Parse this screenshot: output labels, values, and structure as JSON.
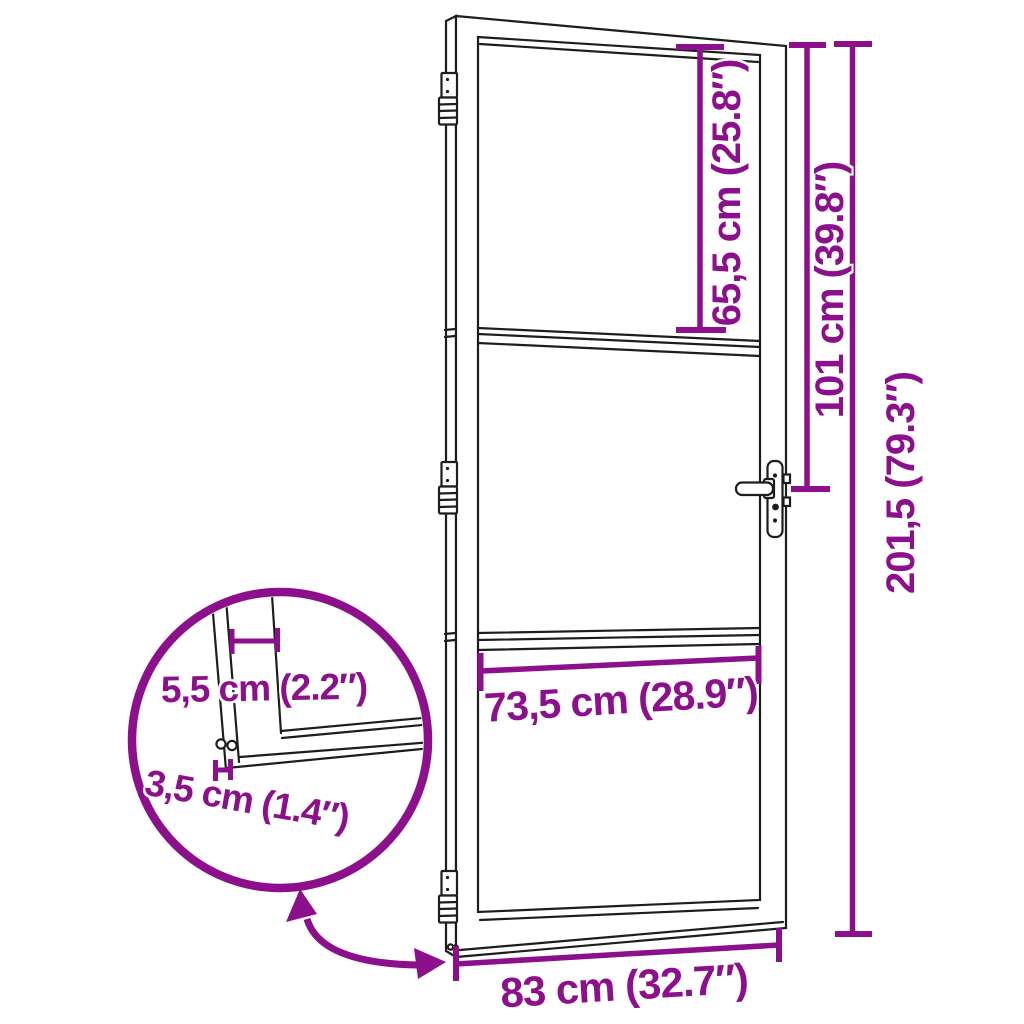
{
  "diagram": {
    "type": "product-dimension-diagram",
    "subject": "glass-door-with-three-panels",
    "colors": {
      "accent": "#8C0F8C",
      "line": "#1D1D1B",
      "background": "#FFFFFF"
    },
    "dimensions": {
      "top_glass_height": "65,5 cm (25.8″)",
      "handle_height": "101 cm (39.8″)",
      "total_height": "201,5 (79.3″)",
      "glass_width": "73,5 cm (28.9″)",
      "total_width": "83 cm (32.7″)",
      "profile_width": "5,5 cm (2.2″)",
      "profile_thickness": "3,5 cm (1.4″)"
    }
  }
}
